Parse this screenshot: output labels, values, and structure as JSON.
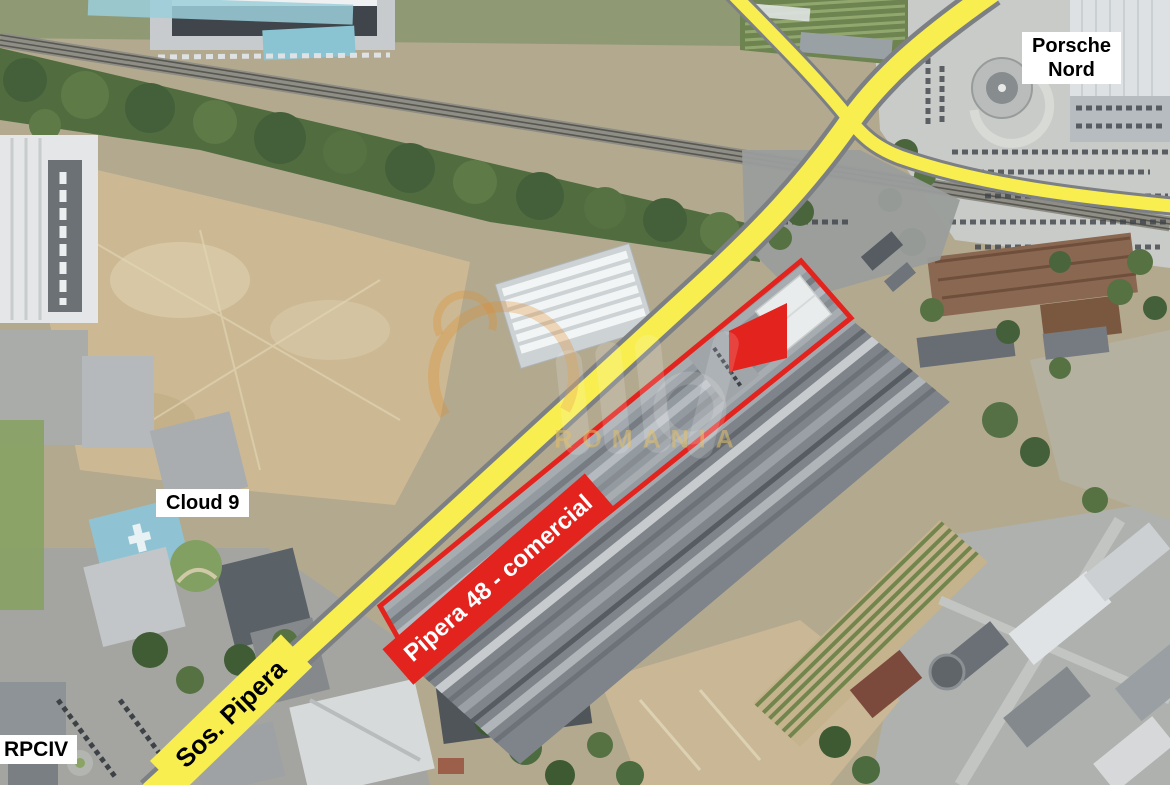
{
  "map": {
    "type": "satellite-annotated",
    "labels": {
      "porsche_nord": {
        "lines": [
          "Porsche",
          "Nord"
        ]
      },
      "cloud9": "Cloud 9",
      "rpciv": "RPCIV",
      "road": "Sos. Pipera",
      "property": "Pipera 48 - comercial"
    },
    "watermark": {
      "text": "ROMANIA"
    },
    "colors": {
      "road_highlight_yellow": "#F8EE4F",
      "annotation_red": "#E3231E",
      "label_background": "#FFFFFF",
      "label_text": "#000000",
      "property_label_text": "#FFFFFF"
    }
  }
}
